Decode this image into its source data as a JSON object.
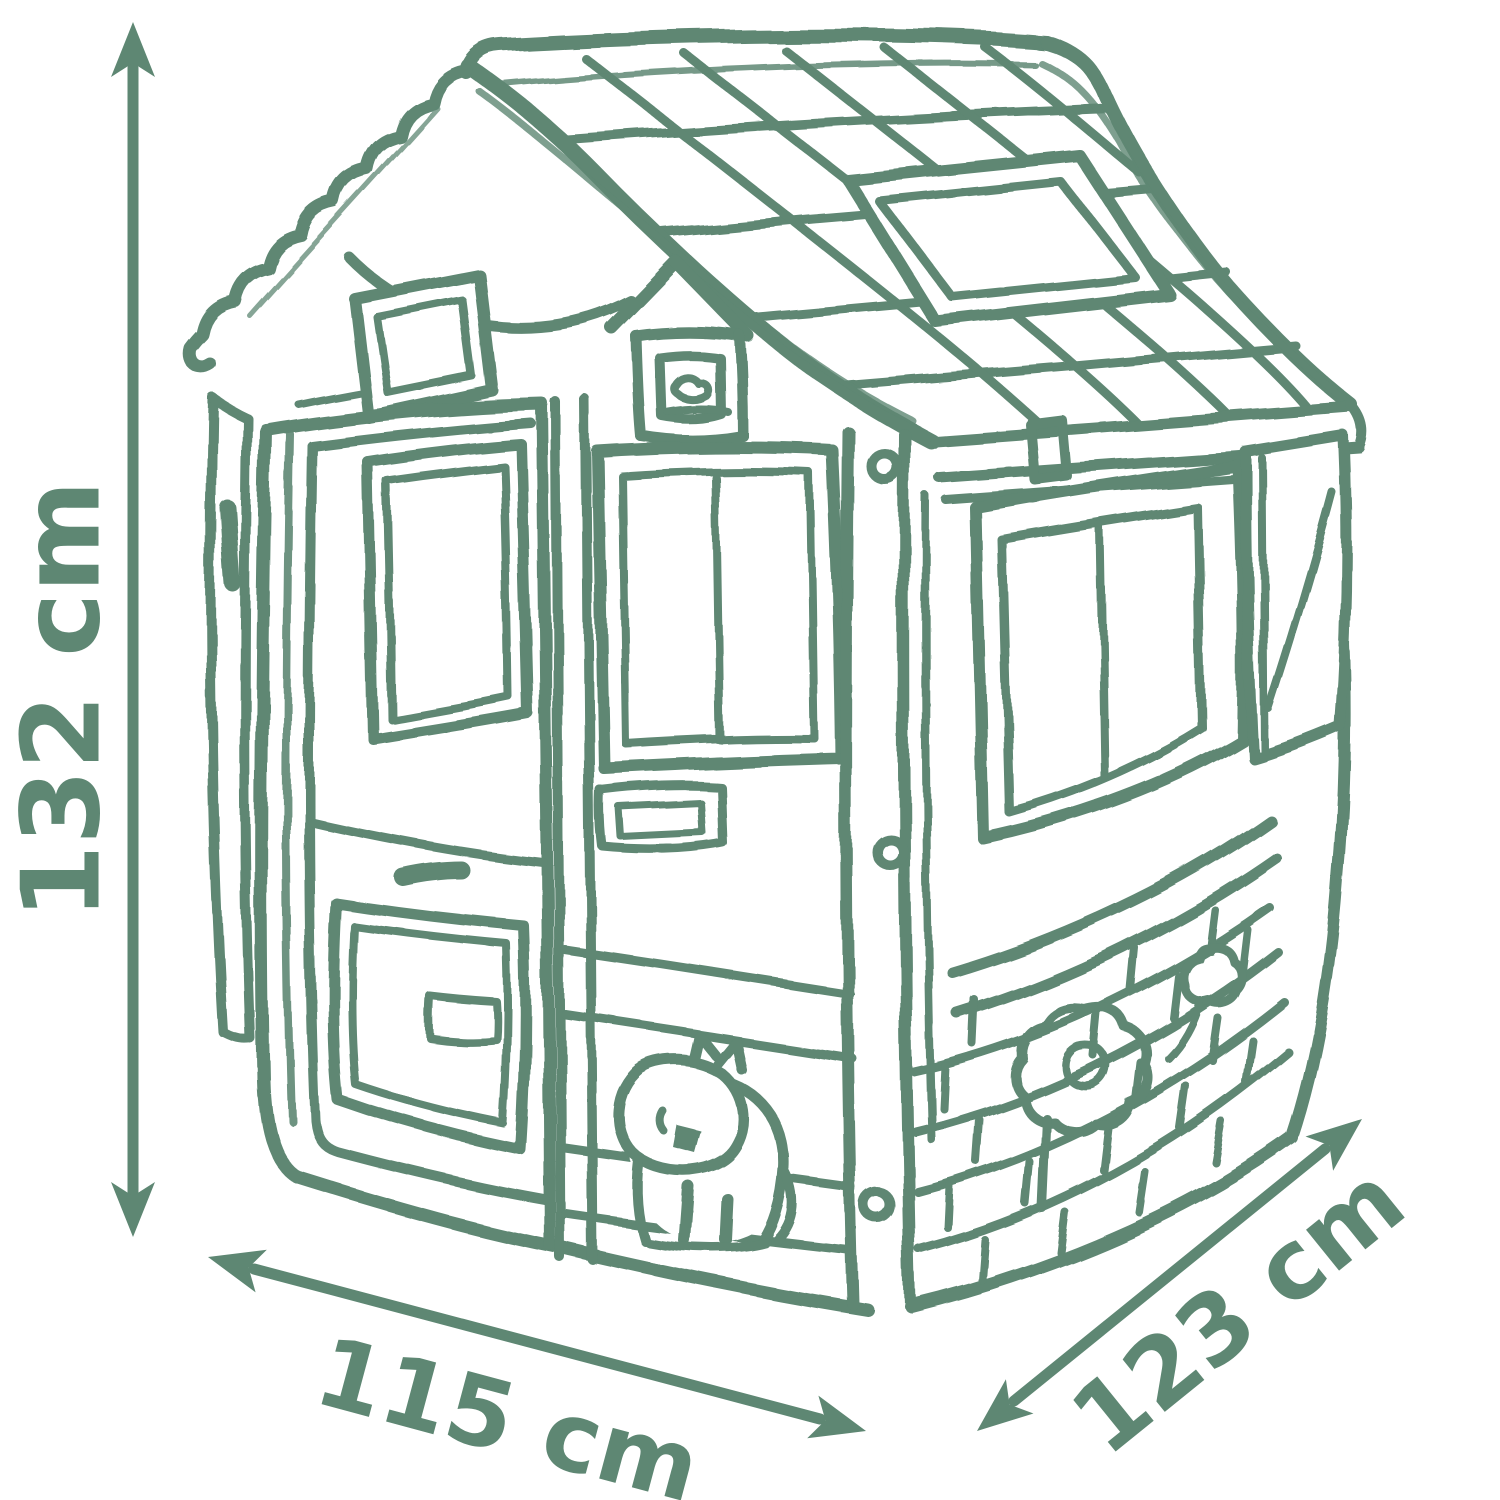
{
  "colors": {
    "background": "#ffffff",
    "ink": "#5e8773"
  },
  "dimension_labels": {
    "height": "132 cm",
    "width": "115 cm",
    "depth": "123 cm"
  }
}
